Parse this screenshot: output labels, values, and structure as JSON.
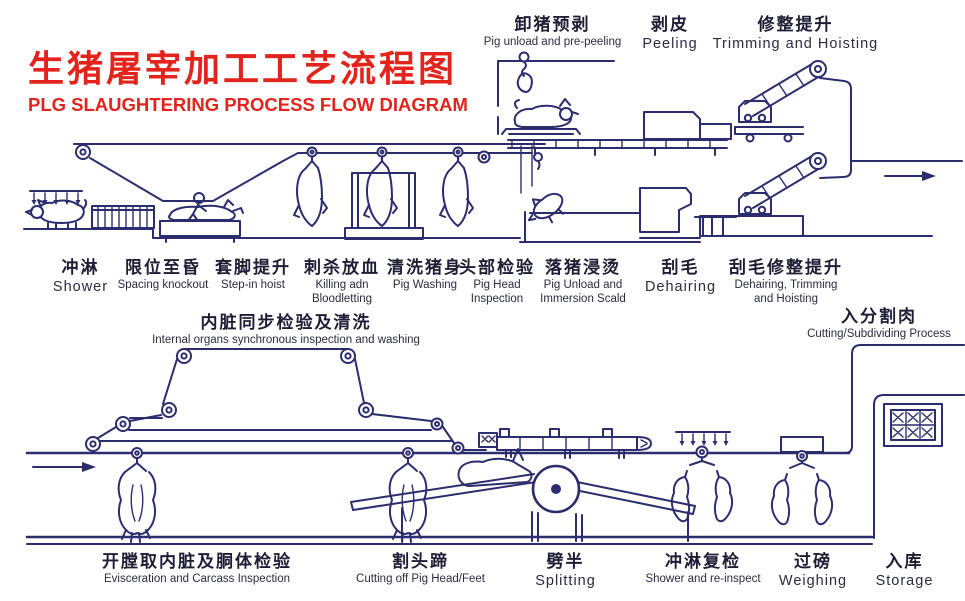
{
  "title": {
    "zh": "生猪屠宰加工工艺流程图",
    "en": "PLG SLAUGHTERING PROCESS FLOW DIAGRAM"
  },
  "colors": {
    "title_red": "#e2241c",
    "line_ink": "#2b2d6e",
    "text_ink": "#22233b",
    "background": "#ffffff"
  },
  "stations": {
    "unload_prepeel": {
      "zh": "卸猪预剥",
      "en": "Pig unload and pre-peeling"
    },
    "peeling": {
      "zh": "剥皮",
      "en": "Peeling"
    },
    "trimming_hoisting": {
      "zh": "修整提升",
      "en": "Trimming and Hoisting"
    },
    "shower": {
      "zh": "冲淋",
      "en": "Shower"
    },
    "spacing_knockout": {
      "zh": "限位至昏",
      "en": "Spacing knockout"
    },
    "step_in_hoist": {
      "zh": "套脚提升",
      "en": "Step-in hoist"
    },
    "killing_bloodletting": {
      "zh": "刺杀放血",
      "en": "Killing adn\nBloodletting"
    },
    "pig_washing": {
      "zh": "清洗猪身",
      "en": "Pig Washing"
    },
    "head_inspection": {
      "zh": "头部检验",
      "en": "Pig Head\nInspection"
    },
    "immersion_scald": {
      "zh": "落猪浸烫",
      "en": "Pig Unload and\nImmersion Scald"
    },
    "dehairing": {
      "zh": "刮毛",
      "en": "Dehairing"
    },
    "dehairing_trimming_hoisting": {
      "zh": "刮毛修整提升",
      "en": "Dehairing, Trimming\nand Hoisting"
    },
    "internal_organs_inspection": {
      "zh": "内脏同步检验及清洗",
      "en": "Internal organs synchronous inspection and washing"
    },
    "cutting_subdividing": {
      "zh": "入分割肉",
      "en": "Cutting/Subdividing Process"
    },
    "evisceration": {
      "zh": "开膛取内脏及胴体检验",
      "en": "Evisceration and Carcass Inspection"
    },
    "cut_head_feet": {
      "zh": "割头蹄",
      "en": "Cutting off Pig Head/Feet"
    },
    "splitting": {
      "zh": "劈半",
      "en": "Splitting"
    },
    "shower_reinspect": {
      "zh": "冲淋复检",
      "en": "Shower and re-inspect"
    },
    "weighing": {
      "zh": "过磅",
      "en": "Weighing"
    },
    "storage": {
      "zh": "入库",
      "en": "Storage"
    }
  }
}
